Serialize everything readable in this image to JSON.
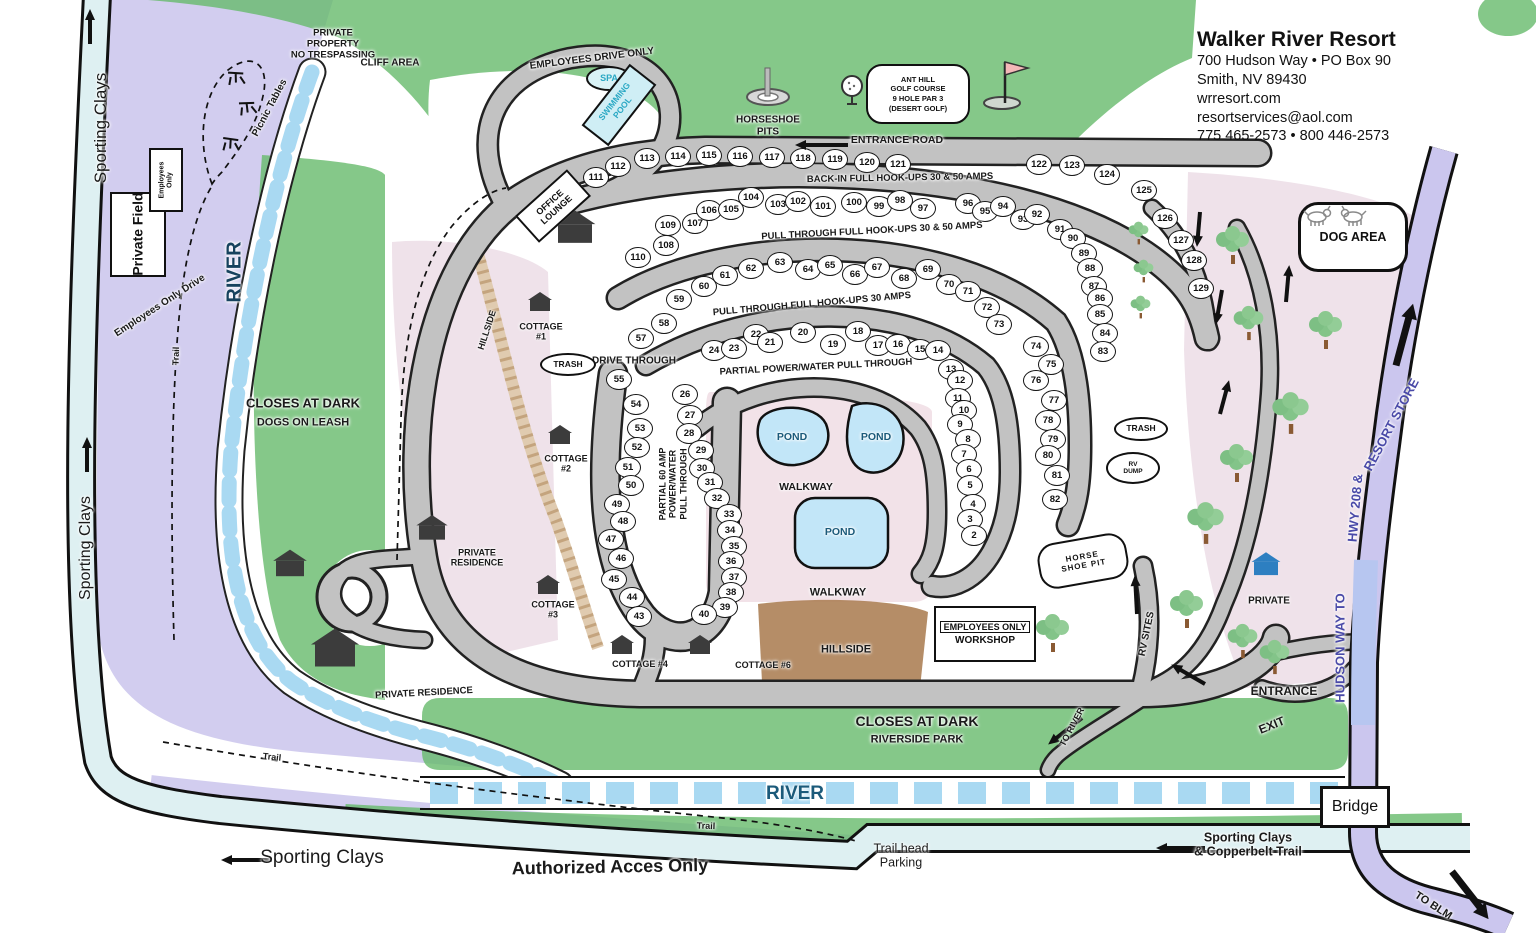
{
  "header": {
    "title": "Walker River Resort",
    "line1": "700 Hudson Way • PO Box 90",
    "line2": "Smith, NV 89430",
    "line3": "wrresort.com",
    "line4": "resortservices@aol.com",
    "line5": "775 465-2573 • 800 446-2573"
  },
  "boxes": {
    "private_field": "Private Field",
    "employees_only_small": "Employees\nOnly",
    "spa": "SPA",
    "swimming_pool": "SWIMMING\nPOOL",
    "office_lounge": "OFFICE\nLOUNGE",
    "golf_sign": "ANT HILL\nGOLF COURSE\n9 HOLE PAR 3\n(DESERT GOLF)",
    "dog_area": "DOG AREA",
    "trash_left": "TRASH",
    "trash_right": "TRASH",
    "rv_dump": "RV\nDUMP",
    "horse_shoe_pit": "HORSE\nSHOE PIT",
    "workshop_line1": "EMPLOYEES ONLY",
    "workshop_line2": "WORKSHOP",
    "bridge": "Bridge"
  },
  "floating_labels": [
    {
      "id": "sporting-clays-top",
      "text": "Sporting Clays",
      "x": 101,
      "y": 128,
      "rot": -90,
      "fs": 17,
      "fw": 400
    },
    {
      "id": "sporting-clays-mid",
      "text": "Sporting Clays",
      "x": 86,
      "y": 548,
      "rot": -90,
      "fs": 16,
      "fw": 400
    },
    {
      "id": "sporting-clays-bottom",
      "text": "Sporting Clays",
      "x": 322,
      "y": 858,
      "rot": 0,
      "fs": 19,
      "fw": 400
    },
    {
      "id": "authorized-access",
      "text": "Authorized Acces Only",
      "x": 610,
      "y": 867,
      "rot": -1,
      "fs": 18,
      "fw": 700
    },
    {
      "id": "river-left",
      "text": "RIVER",
      "x": 235,
      "y": 272,
      "rot": -90,
      "fs": 20,
      "fw": 700,
      "color": "#16425e"
    },
    {
      "id": "river-bottom",
      "text": "RIVER",
      "x": 795,
      "y": 794,
      "rot": 0,
      "fs": 19,
      "fw": 700,
      "color": "#1b5a7a"
    },
    {
      "id": "trail-vertical",
      "text": "Trail",
      "x": 176,
      "y": 356,
      "rot": -88,
      "fs": 9,
      "fw": 600
    },
    {
      "id": "trail-bottom-1",
      "text": "Trail",
      "x": 272,
      "y": 757,
      "rot": 6,
      "fs": 9,
      "fw": 600
    },
    {
      "id": "trail-bottom-2",
      "text": "Trail",
      "x": 706,
      "y": 826,
      "rot": 2,
      "fs": 9,
      "fw": 600
    },
    {
      "id": "picnic-tables",
      "text": "Picnic Tables",
      "x": 270,
      "y": 108,
      "rot": -62,
      "fs": 10,
      "fw": 600
    },
    {
      "id": "private-property",
      "text": "PRIVATE\nPROPERTY\nNO TRESPASSING",
      "x": 333,
      "y": 45,
      "rot": 0,
      "fs": 9.5,
      "fw": 700
    },
    {
      "id": "cliff-area",
      "text": "CLIFF AREA",
      "x": 390,
      "y": 63,
      "rot": 0,
      "fs": 10,
      "fw": 700
    },
    {
      "id": "employees-drive-only",
      "text": "EMPLOYEES DRIVE ONLY",
      "x": 592,
      "y": 59,
      "rot": -7,
      "fs": 10,
      "fw": 700
    },
    {
      "id": "closes-at-dark-left",
      "text": "CLOSES AT DARK",
      "x": 303,
      "y": 404,
      "rot": 0,
      "fs": 13,
      "fw": 700
    },
    {
      "id": "dogs-on-leash",
      "text": "DOGS ON LEASH",
      "x": 303,
      "y": 423,
      "rot": 0,
      "fs": 11,
      "fw": 700
    },
    {
      "id": "employees-only-drive",
      "text": "Employees Only Drive",
      "x": 160,
      "y": 306,
      "rot": -33,
      "fs": 10,
      "fw": 600
    },
    {
      "id": "horseshoe-pits",
      "text": "HORSESHOE\nPITS",
      "x": 768,
      "y": 126,
      "rot": 0,
      "fs": 10,
      "fw": 700
    },
    {
      "id": "entrance-road",
      "text": "ENTRANCE ROAD",
      "x": 897,
      "y": 140,
      "rot": 0,
      "fs": 10.5,
      "fw": 700
    },
    {
      "id": "backin-hookups",
      "text": "BACK-IN FULL HOOK-UPS 30 & 50 AMPS",
      "x": 900,
      "y": 179,
      "rot": -1,
      "fs": 9.5,
      "fw": 700
    },
    {
      "id": "pullthrough-3050",
      "text": "PULL THROUGH FULL HOOK-UPS 30 & 50 AMPS",
      "x": 872,
      "y": 232,
      "rot": -3,
      "fs": 9.5,
      "fw": 700
    },
    {
      "id": "pullthrough-30",
      "text": "PULL THROUGH FULL HOOK-UPS 30 AMPS",
      "x": 812,
      "y": 305,
      "rot": -5,
      "fs": 9.5,
      "fw": 700
    },
    {
      "id": "partial-powerwater",
      "text": "PARTIAL POWER/WATER PULL THROUGH",
      "x": 816,
      "y": 368,
      "rot": -3,
      "fs": 9.5,
      "fw": 700
    },
    {
      "id": "partial-60amp",
      "text": "PARTIAL 60 AMP\nPOWER/WATER\nPULL THROUGH",
      "x": 673,
      "y": 484,
      "rot": -90,
      "fs": 9,
      "fw": 700
    },
    {
      "id": "drive-through",
      "text": "DRIVE THROUGH",
      "x": 634,
      "y": 361,
      "rot": 0,
      "fs": 10,
      "fw": 700
    },
    {
      "id": "hillside-left",
      "text": "HILLSIDE",
      "x": 487,
      "y": 330,
      "rot": -72,
      "fs": 9,
      "fw": 600
    },
    {
      "id": "hillside-center",
      "text": "HILLSIDE",
      "x": 846,
      "y": 650,
      "rot": 0,
      "fs": 11,
      "fw": 700
    },
    {
      "id": "walkway-upper",
      "text": "WALKWAY",
      "x": 806,
      "y": 487,
      "rot": 0,
      "fs": 10.5,
      "fw": 700
    },
    {
      "id": "walkway-lower",
      "text": "WALKWAY",
      "x": 838,
      "y": 593,
      "rot": 0,
      "fs": 11,
      "fw": 700
    },
    {
      "id": "pond-1",
      "text": "POND",
      "x": 792,
      "y": 437,
      "rot": 0,
      "fs": 10.5,
      "fw": 700,
      "color": "#1b5a7a"
    },
    {
      "id": "pond-2",
      "text": "POND",
      "x": 876,
      "y": 437,
      "rot": 0,
      "fs": 10.5,
      "fw": 700,
      "color": "#1b5a7a"
    },
    {
      "id": "pond-3",
      "text": "POND",
      "x": 840,
      "y": 532,
      "rot": 0,
      "fs": 10.5,
      "fw": 700,
      "color": "#1b5a7a"
    },
    {
      "id": "cottage-1",
      "text": "COTTAGE\n#1",
      "x": 541,
      "y": 332,
      "rot": 0,
      "fs": 9,
      "fw": 700
    },
    {
      "id": "cottage-2",
      "text": "COTTAGE\n#2",
      "x": 566,
      "y": 464,
      "rot": 0,
      "fs": 9,
      "fw": 700
    },
    {
      "id": "cottage-3",
      "text": "COTTAGE\n#3",
      "x": 553,
      "y": 610,
      "rot": 0,
      "fs": 9,
      "fw": 700
    },
    {
      "id": "cottage-4",
      "text": "COTTAGE #4",
      "x": 640,
      "y": 664,
      "rot": 0,
      "fs": 9,
      "fw": 700
    },
    {
      "id": "cottage-6",
      "text": "COTTAGE #6",
      "x": 763,
      "y": 665,
      "rot": 0,
      "fs": 9,
      "fw": 700
    },
    {
      "id": "private-residence-1",
      "text": "PRIVATE\nRESIDENCE",
      "x": 477,
      "y": 558,
      "rot": 0,
      "fs": 9,
      "fw": 700
    },
    {
      "id": "private-residence-2",
      "text": "PRIVATE RESIDENCE",
      "x": 424,
      "y": 694,
      "rot": -3,
      "fs": 9.5,
      "fw": 700
    },
    {
      "id": "rv-sites",
      "text": "RV SITES",
      "x": 1147,
      "y": 634,
      "rot": -78,
      "fs": 10,
      "fw": 700
    },
    {
      "id": "private-right",
      "text": "PRIVATE",
      "x": 1269,
      "y": 601,
      "rot": 0,
      "fs": 10,
      "fw": 700
    },
    {
      "id": "hudson-way-1",
      "text": "HUDSON WAY TO",
      "x": 1341,
      "y": 648,
      "rot": -90,
      "fs": 13,
      "fw": 700,
      "color": "#4a4aa8"
    },
    {
      "id": "hudson-way-2",
      "text": "HWY 208  &",
      "x": 1356,
      "y": 508,
      "rot": -85,
      "fs": 13,
      "fw": 700,
      "color": "#4a4aa8"
    },
    {
      "id": "hudson-way-3",
      "text": "RESORT STORE",
      "x": 1392,
      "y": 425,
      "rot": -62,
      "fs": 13,
      "fw": 700,
      "color": "#4a4aa8"
    },
    {
      "id": "entrance-bottom",
      "text": "ENTRANCE",
      "x": 1284,
      "y": 692,
      "rot": 0,
      "fs": 12,
      "fw": 700
    },
    {
      "id": "exit-bottom",
      "text": "EXIT",
      "x": 1272,
      "y": 726,
      "rot": -22,
      "fs": 12,
      "fw": 700
    },
    {
      "id": "closes-at-dark-bottom",
      "text": "CLOSES AT DARK",
      "x": 917,
      "y": 721,
      "rot": 0,
      "fs": 14,
      "fw": 700
    },
    {
      "id": "riverside-park",
      "text": "RIVERSIDE PARK",
      "x": 917,
      "y": 740,
      "rot": 0,
      "fs": 11,
      "fw": 700
    },
    {
      "id": "to-river",
      "text": "TO RIVER",
      "x": 1072,
      "y": 727,
      "rot": -62,
      "fs": 9,
      "fw": 700
    },
    {
      "id": "copperbelt",
      "text": "Sporting Clays\n& Copperbelt Trail",
      "x": 1248,
      "y": 845,
      "rot": 0,
      "fs": 12.5,
      "fw": 600
    },
    {
      "id": "trailhead-parking",
      "text": "Trail head\nParking",
      "x": 901,
      "y": 856,
      "rot": 0,
      "fs": 12.5,
      "fw": 400
    },
    {
      "id": "to-blm",
      "text": "TO BLM",
      "x": 1433,
      "y": 906,
      "rot": 33,
      "fs": 11,
      "fw": 700
    }
  ],
  "sites": [
    {
      "n": "111",
      "x": 595,
      "y": 176
    },
    {
      "n": "112",
      "x": 617,
      "y": 165
    },
    {
      "n": "113",
      "x": 646,
      "y": 157
    },
    {
      "n": "114",
      "x": 677,
      "y": 155
    },
    {
      "n": "115",
      "x": 708,
      "y": 154
    },
    {
      "n": "116",
      "x": 739,
      "y": 155
    },
    {
      "n": "117",
      "x": 771,
      "y": 156
    },
    {
      "n": "118",
      "x": 802,
      "y": 157
    },
    {
      "n": "119",
      "x": 834,
      "y": 158
    },
    {
      "n": "120",
      "x": 866,
      "y": 161
    },
    {
      "n": "121",
      "x": 897,
      "y": 163
    },
    {
      "n": "122",
      "x": 1038,
      "y": 163
    },
    {
      "n": "123",
      "x": 1071,
      "y": 164
    },
    {
      "n": "124",
      "x": 1106,
      "y": 173
    },
    {
      "n": "125",
      "x": 1143,
      "y": 189
    },
    {
      "n": "126",
      "x": 1164,
      "y": 217
    },
    {
      "n": "127",
      "x": 1180,
      "y": 239
    },
    {
      "n": "128",
      "x": 1193,
      "y": 259
    },
    {
      "n": "129",
      "x": 1200,
      "y": 287
    },
    {
      "n": "110",
      "x": 637,
      "y": 256
    },
    {
      "n": "109",
      "x": 667,
      "y": 224
    },
    {
      "n": "108",
      "x": 665,
      "y": 244
    },
    {
      "n": "107",
      "x": 694,
      "y": 222
    },
    {
      "n": "106",
      "x": 708,
      "y": 209
    },
    {
      "n": "105",
      "x": 730,
      "y": 208
    },
    {
      "n": "104",
      "x": 750,
      "y": 196
    },
    {
      "n": "103",
      "x": 777,
      "y": 203
    },
    {
      "n": "102",
      "x": 797,
      "y": 200
    },
    {
      "n": "101",
      "x": 822,
      "y": 205
    },
    {
      "n": "100",
      "x": 853,
      "y": 201
    },
    {
      "n": "99",
      "x": 878,
      "y": 205
    },
    {
      "n": "98",
      "x": 899,
      "y": 199
    },
    {
      "n": "97",
      "x": 922,
      "y": 207
    },
    {
      "n": "96",
      "x": 967,
      "y": 202
    },
    {
      "n": "95",
      "x": 984,
      "y": 210
    },
    {
      "n": "94",
      "x": 1002,
      "y": 205
    },
    {
      "n": "93",
      "x": 1022,
      "y": 218
    },
    {
      "n": "92",
      "x": 1036,
      "y": 213
    },
    {
      "n": "91",
      "x": 1059,
      "y": 228
    },
    {
      "n": "90",
      "x": 1072,
      "y": 237
    },
    {
      "n": "89",
      "x": 1083,
      "y": 252
    },
    {
      "n": "88",
      "x": 1089,
      "y": 267
    },
    {
      "n": "87",
      "x": 1093,
      "y": 285
    },
    {
      "n": "86",
      "x": 1099,
      "y": 297
    },
    {
      "n": "85",
      "x": 1099,
      "y": 313
    },
    {
      "n": "84",
      "x": 1104,
      "y": 332
    },
    {
      "n": "83",
      "x": 1102,
      "y": 350
    },
    {
      "n": "57",
      "x": 640,
      "y": 337
    },
    {
      "n": "58",
      "x": 663,
      "y": 322
    },
    {
      "n": "59",
      "x": 678,
      "y": 298
    },
    {
      "n": "60",
      "x": 703,
      "y": 285
    },
    {
      "n": "61",
      "x": 724,
      "y": 274
    },
    {
      "n": "62",
      "x": 750,
      "y": 267
    },
    {
      "n": "63",
      "x": 779,
      "y": 261
    },
    {
      "n": "64",
      "x": 807,
      "y": 268
    },
    {
      "n": "65",
      "x": 829,
      "y": 264
    },
    {
      "n": "66",
      "x": 854,
      "y": 273
    },
    {
      "n": "67",
      "x": 876,
      "y": 266
    },
    {
      "n": "68",
      "x": 903,
      "y": 277
    },
    {
      "n": "69",
      "x": 927,
      "y": 268
    },
    {
      "n": "70",
      "x": 948,
      "y": 283
    },
    {
      "n": "71",
      "x": 967,
      "y": 290
    },
    {
      "n": "72",
      "x": 986,
      "y": 306
    },
    {
      "n": "73",
      "x": 998,
      "y": 323
    },
    {
      "n": "74",
      "x": 1035,
      "y": 345
    },
    {
      "n": "75",
      "x": 1050,
      "y": 363
    },
    {
      "n": "76",
      "x": 1035,
      "y": 379
    },
    {
      "n": "77",
      "x": 1053,
      "y": 399
    },
    {
      "n": "78",
      "x": 1047,
      "y": 419
    },
    {
      "n": "79",
      "x": 1052,
      "y": 438
    },
    {
      "n": "80",
      "x": 1047,
      "y": 454
    },
    {
      "n": "81",
      "x": 1056,
      "y": 474
    },
    {
      "n": "82",
      "x": 1054,
      "y": 498
    },
    {
      "n": "24",
      "x": 713,
      "y": 349
    },
    {
      "n": "23",
      "x": 733,
      "y": 347
    },
    {
      "n": "22",
      "x": 755,
      "y": 333
    },
    {
      "n": "21",
      "x": 769,
      "y": 341
    },
    {
      "n": "20",
      "x": 802,
      "y": 331
    },
    {
      "n": "19",
      "x": 832,
      "y": 343
    },
    {
      "n": "18",
      "x": 857,
      "y": 330
    },
    {
      "n": "17",
      "x": 877,
      "y": 344
    },
    {
      "n": "16",
      "x": 897,
      "y": 343
    },
    {
      "n": "15",
      "x": 919,
      "y": 348
    },
    {
      "n": "14",
      "x": 937,
      "y": 349
    },
    {
      "n": "13",
      "x": 950,
      "y": 368
    },
    {
      "n": "12",
      "x": 959,
      "y": 379
    },
    {
      "n": "11",
      "x": 957,
      "y": 397
    },
    {
      "n": "10",
      "x": 963,
      "y": 409
    },
    {
      "n": "9",
      "x": 959,
      "y": 423
    },
    {
      "n": "8",
      "x": 967,
      "y": 438
    },
    {
      "n": "7",
      "x": 963,
      "y": 453
    },
    {
      "n": "6",
      "x": 968,
      "y": 468
    },
    {
      "n": "5",
      "x": 969,
      "y": 484
    },
    {
      "n": "4",
      "x": 972,
      "y": 503
    },
    {
      "n": "3",
      "x": 969,
      "y": 518
    },
    {
      "n": "2",
      "x": 973,
      "y": 534
    },
    {
      "n": "55",
      "x": 618,
      "y": 378
    },
    {
      "n": "54",
      "x": 635,
      "y": 403
    },
    {
      "n": "53",
      "x": 639,
      "y": 427
    },
    {
      "n": "52",
      "x": 636,
      "y": 446
    },
    {
      "n": "51",
      "x": 627,
      "y": 466
    },
    {
      "n": "50",
      "x": 630,
      "y": 484
    },
    {
      "n": "49",
      "x": 616,
      "y": 503
    },
    {
      "n": "48",
      "x": 622,
      "y": 520
    },
    {
      "n": "47",
      "x": 610,
      "y": 538
    },
    {
      "n": "46",
      "x": 620,
      "y": 557
    },
    {
      "n": "45",
      "x": 613,
      "y": 578
    },
    {
      "n": "44",
      "x": 631,
      "y": 596
    },
    {
      "n": "43",
      "x": 638,
      "y": 615
    },
    {
      "n": "26",
      "x": 684,
      "y": 393
    },
    {
      "n": "27",
      "x": 689,
      "y": 414
    },
    {
      "n": "28",
      "x": 688,
      "y": 432
    },
    {
      "n": "29",
      "x": 700,
      "y": 449
    },
    {
      "n": "30",
      "x": 701,
      "y": 467
    },
    {
      "n": "31",
      "x": 709,
      "y": 481
    },
    {
      "n": "32",
      "x": 716,
      "y": 497
    },
    {
      "n": "33",
      "x": 728,
      "y": 513
    },
    {
      "n": "34",
      "x": 729,
      "y": 529
    },
    {
      "n": "35",
      "x": 733,
      "y": 545
    },
    {
      "n": "36",
      "x": 730,
      "y": 560
    },
    {
      "n": "37",
      "x": 733,
      "y": 576
    },
    {
      "n": "38",
      "x": 730,
      "y": 591
    },
    {
      "n": "39",
      "x": 724,
      "y": 606
    },
    {
      "n": "40",
      "x": 703,
      "y": 613
    }
  ],
  "trees": [
    {
      "x": 1242,
      "y": 240,
      "s": 1
    },
    {
      "x": 1258,
      "y": 318,
      "s": 0.9
    },
    {
      "x": 1335,
      "y": 325,
      "s": 1
    },
    {
      "x": 1300,
      "y": 408,
      "s": 1.1
    },
    {
      "x": 1246,
      "y": 458,
      "s": 1
    },
    {
      "x": 1215,
      "y": 518,
      "s": 1.1
    },
    {
      "x": 1196,
      "y": 604,
      "s": 1
    },
    {
      "x": 1252,
      "y": 636,
      "s": 0.9
    },
    {
      "x": 1284,
      "y": 652,
      "s": 0.9
    },
    {
      "x": 1062,
      "y": 628,
      "s": 1
    },
    {
      "x": 1148,
      "y": 228,
      "s": 0.6
    },
    {
      "x": 1153,
      "y": 266,
      "s": 0.6
    },
    {
      "x": 1150,
      "y": 302,
      "s": 0.6
    }
  ],
  "houses": [
    {
      "x": 540,
      "y": 305,
      "s": 1
    },
    {
      "x": 560,
      "y": 438,
      "s": 1
    },
    {
      "x": 548,
      "y": 588,
      "s": 1
    },
    {
      "x": 622,
      "y": 648,
      "s": 1
    },
    {
      "n": "",
      "x": 700,
      "y": 648,
      "s": 1
    },
    {
      "x": 432,
      "y": 532,
      "s": 1.3
    },
    {
      "x": 335,
      "y": 655,
      "s": 2
    },
    {
      "x": 290,
      "y": 568,
      "s": 1.4
    },
    {
      "x": 575,
      "y": 233,
      "s": 1.7
    },
    {
      "x": 1266,
      "y": 568,
      "s": 1.2,
      "variant": "blue"
    }
  ],
  "arrows": [
    {
      "id": "sporting-clays-up-top",
      "x": 90,
      "y": 42,
      "rot": -90,
      "len": 26
    },
    {
      "id": "sporting-clays-up-mid",
      "x": 87,
      "y": 470,
      "rot": -90,
      "len": 26
    },
    {
      "id": "entrance-road-arrow",
      "x": 848,
      "y": 143,
      "rot": 180,
      "len": 44
    },
    {
      "id": "sporting-clays-left",
      "x": 272,
      "y": 858,
      "rot": 180,
      "len": 42
    },
    {
      "id": "copperbelt-arrow",
      "x": 1205,
      "y": 846,
      "rot": 180,
      "len": 40
    },
    {
      "id": "hudson-way-up",
      "x": 1396,
      "y": 362,
      "rot": -75,
      "len": 52,
      "big": true
    },
    {
      "id": "rv-sites-up",
      "x": 1137,
      "y": 612,
      "rot": -93,
      "len": 30
    },
    {
      "id": "to-river-arrow",
      "x": 1082,
      "y": 716,
      "rot": 142,
      "len": 34
    },
    {
      "id": "to-blm-arrow",
      "x": 1452,
      "y": 868,
      "rot": 52,
      "len": 48,
      "big": true
    },
    {
      "id": "exit-loop-arrow",
      "x": 1205,
      "y": 682,
      "rot": -150,
      "len": 30
    },
    {
      "id": "median-down-1",
      "x": 1200,
      "y": 210,
      "rot": 95,
      "len": 26
    },
    {
      "id": "median-down-2",
      "x": 1222,
      "y": 288,
      "rot": 100,
      "len": 26
    },
    {
      "id": "median-up",
      "x": 1286,
      "y": 300,
      "rot": -85,
      "len": 28
    },
    {
      "id": "road-up-right",
      "x": 1220,
      "y": 412,
      "rot": -75,
      "len": 26
    }
  ],
  "colors": {
    "green": "#66ba6c",
    "lavender": "#cac4ec",
    "road_gray": "#c2c2c2",
    "water": "#a9d9f2",
    "pink": "#ecdde6",
    "brown": "#ad8157",
    "path_cyan": "#def0f2",
    "ink": "#111111",
    "hudson_blue": "#4a4aa8",
    "pool_teal": "#2aa8c4"
  }
}
